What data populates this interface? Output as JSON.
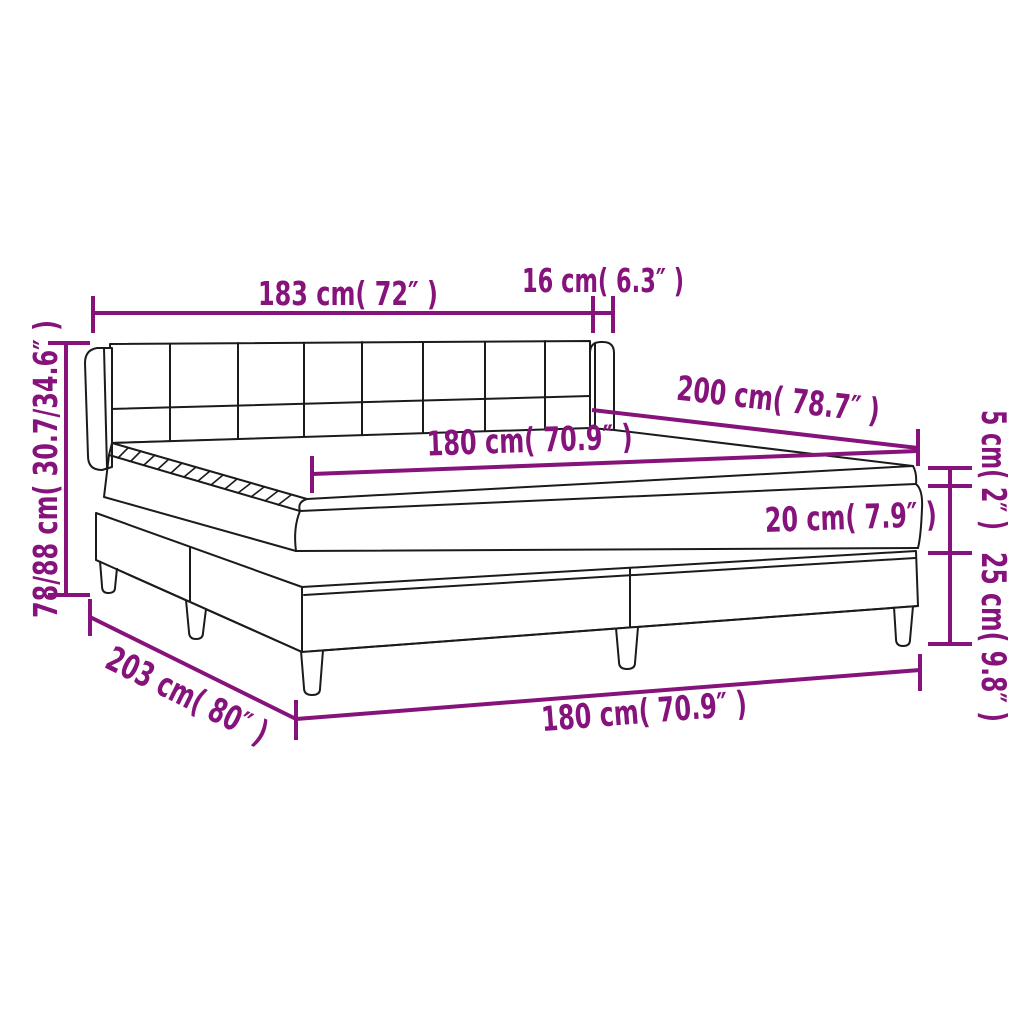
{
  "diagram": {
    "name": "box-spring-bed-dimension-diagram",
    "background_color": "#ffffff",
    "outline_color": "#1b1b1b",
    "accent_color": "#86137B",
    "dimensions": {
      "headboard_width": "183 cm( 72″ )",
      "headboard_wing_depth": "16 cm( 6.3″ )",
      "bed_length": "200 cm( 78.7″ )",
      "mattress_width": "180 cm( 70.9″ )",
      "mattress_top_height": "5 cm( 2″ )",
      "mattress_height": "20 cm( 7.9″ )",
      "base_height_with_legs": "25 cm( 9.8″ )",
      "overall_height": "78/88 cm( 30.7/34.6″ )",
      "base_length": "203 cm( 80″ )",
      "base_width": "180 cm( 70.9″ )"
    }
  }
}
